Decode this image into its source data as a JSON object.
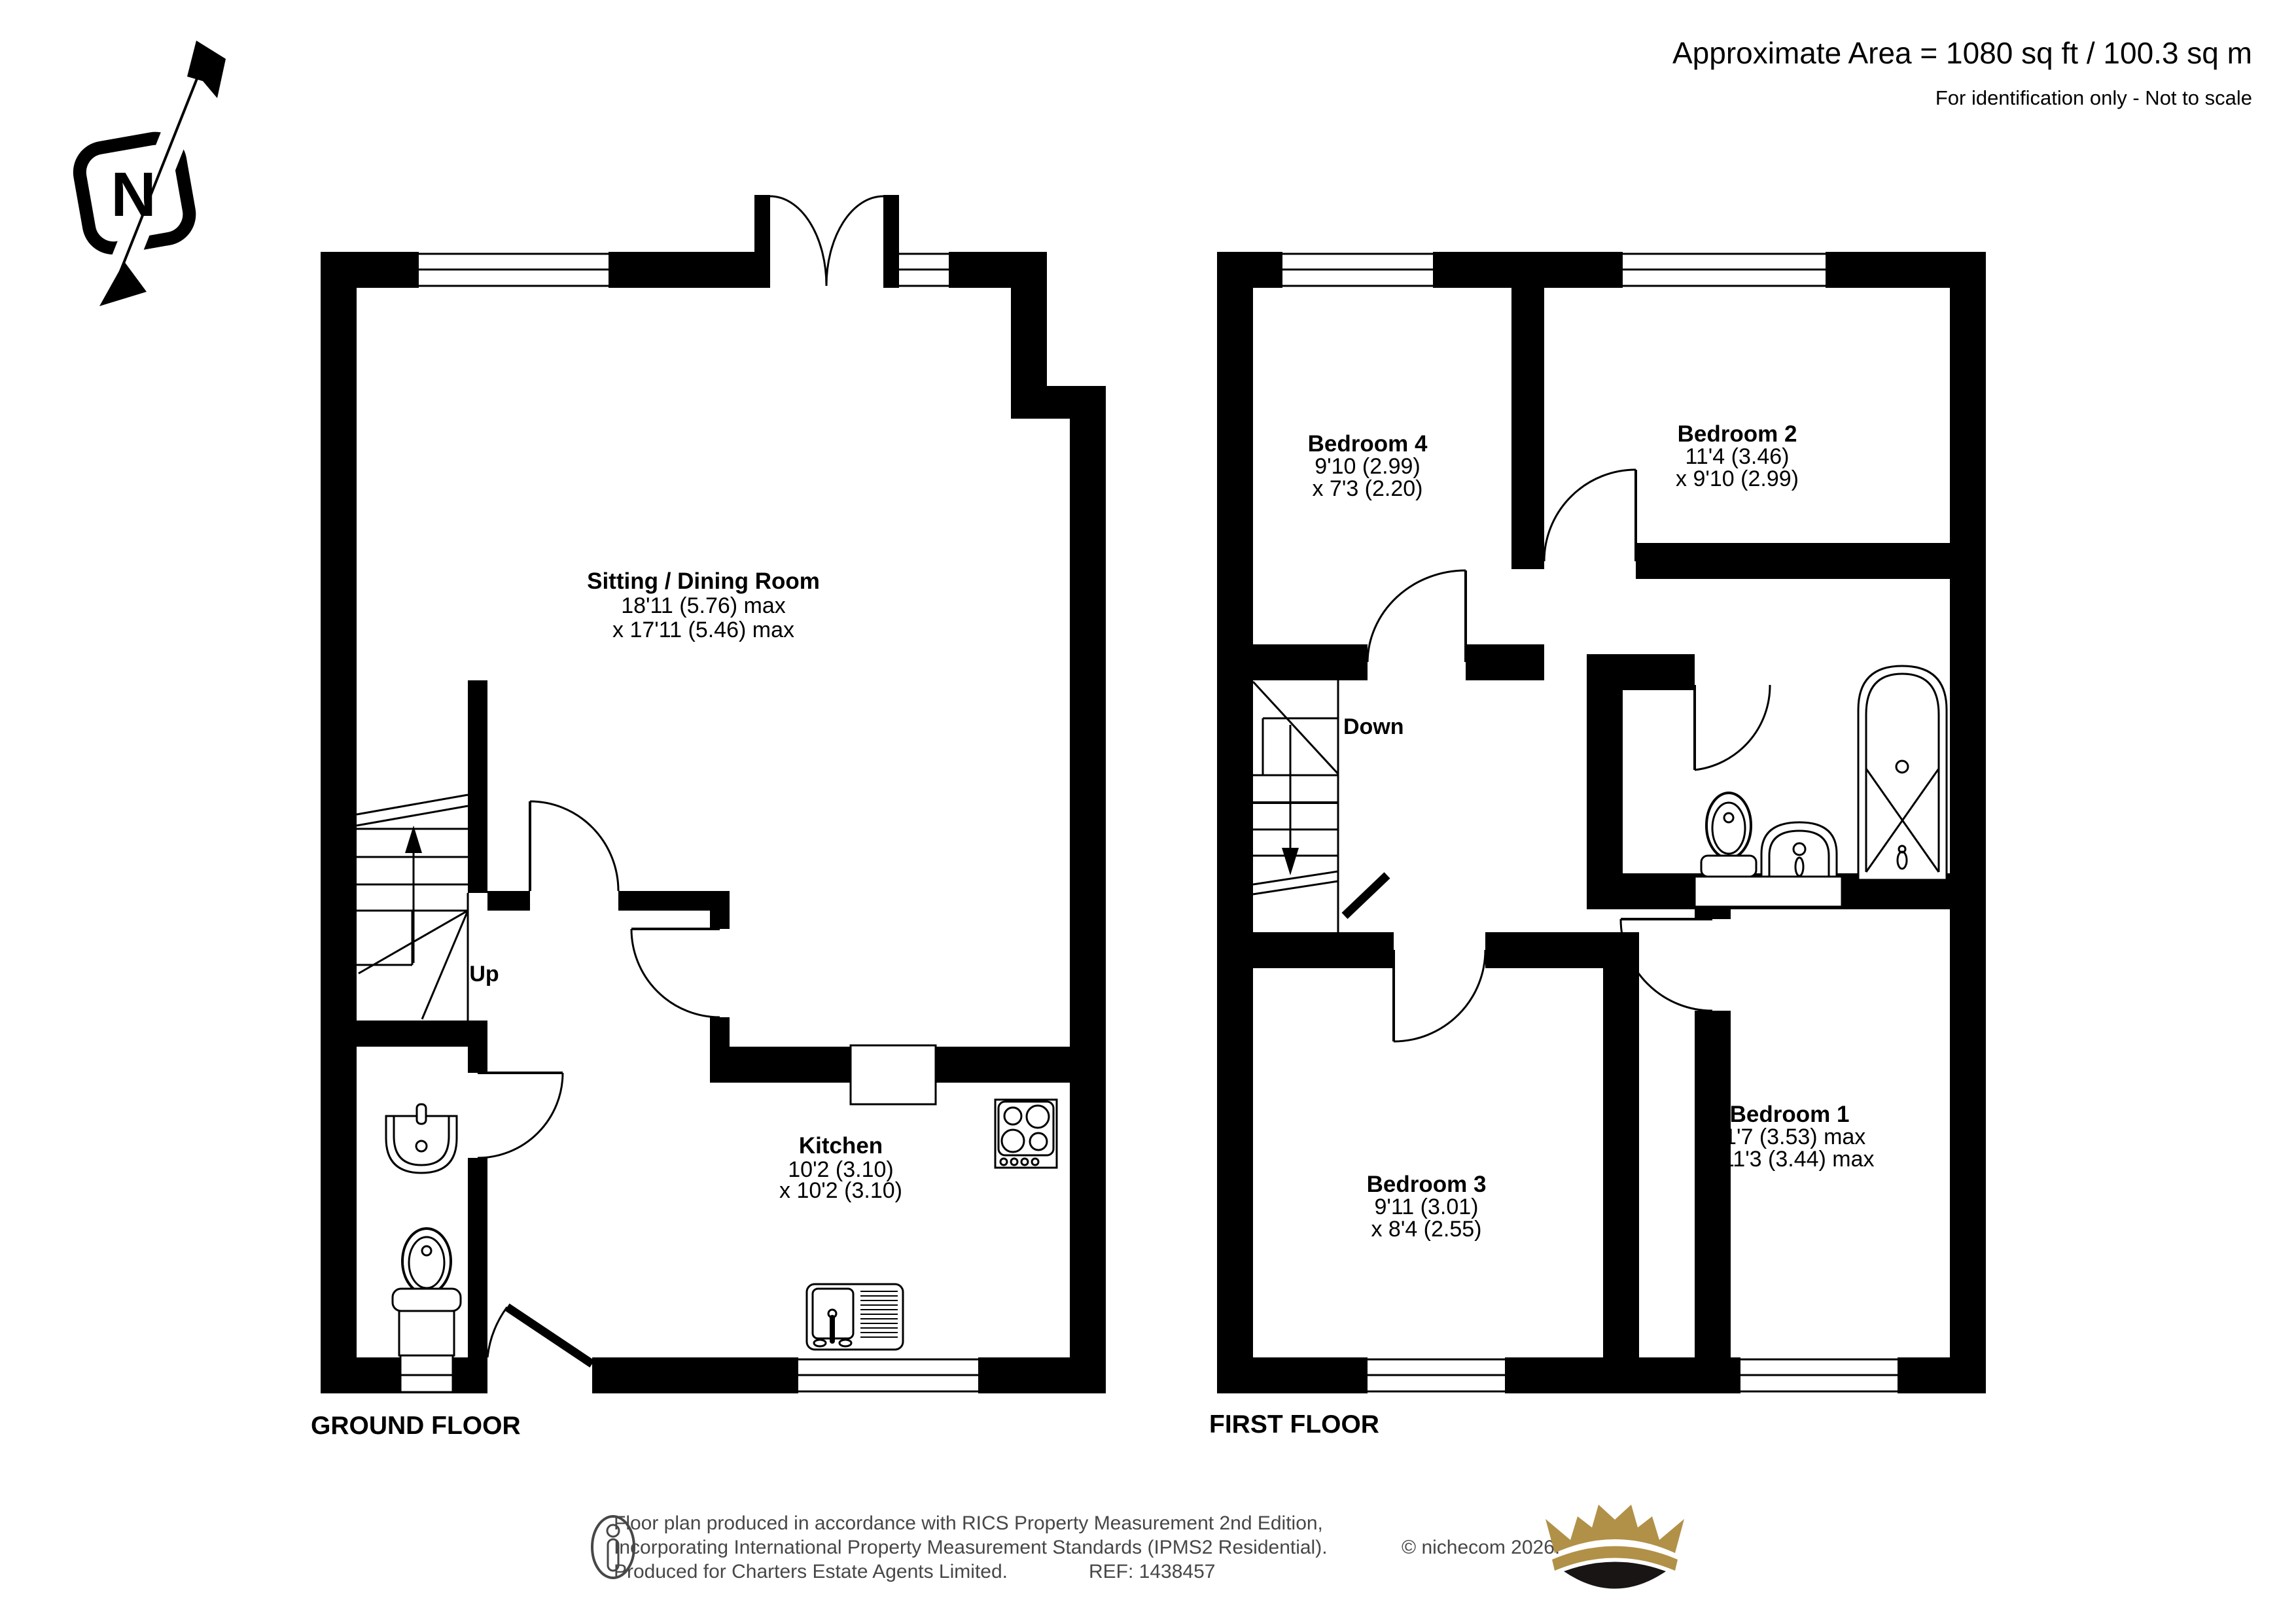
{
  "header": {
    "area": "Approximate Area = 1080 sq ft / 100.3 sq m",
    "note": "For identification only - Not to scale"
  },
  "compass": {
    "north": "N"
  },
  "ground_floor": {
    "title": "GROUND FLOOR",
    "stairs_label": "Up",
    "rooms": {
      "sitting_dining": {
        "name": "Sitting / Dining Room",
        "dim1": "18'11 (5.76) max",
        "dim2": "x 17'11 (5.46) max"
      },
      "kitchen": {
        "name": "Kitchen",
        "dim1": "10'2 (3.10)",
        "dim2": "x 10'2 (3.10)"
      }
    }
  },
  "first_floor": {
    "title": "FIRST FLOOR",
    "stairs_label": "Down",
    "rooms": {
      "bedroom1": {
        "name": "Bedroom 1",
        "dim1": "11'7 (3.53) max",
        "dim2": "x 11'3 (3.44) max"
      },
      "bedroom2": {
        "name": "Bedroom 2",
        "dim1": "11'4 (3.46)",
        "dim2": "x 9'10 (2.99)"
      },
      "bedroom3": {
        "name": "Bedroom 3",
        "dim1": "9'11 (3.01)",
        "dim2": "x 8'4 (2.55)"
      },
      "bedroom4": {
        "name": "Bedroom 4",
        "dim1": "9'10 (2.99)",
        "dim2": "x 7'3 (2.20)"
      }
    }
  },
  "footer": {
    "line1": "Floor plan produced in accordance with RICS Property Measurement 2nd Edition,",
    "line2": "Incorporating International Property Measurement Standards (IPMS2 Residential).",
    "copyright": "© nichecom 2026.",
    "line3": "Produced for Charters Estate Agents Limited.",
    "ref": "REF: 1438457"
  },
  "colors": {
    "wall": "#000000",
    "crown_gold": "#B19148",
    "crown_dark": "#1A1515"
  }
}
